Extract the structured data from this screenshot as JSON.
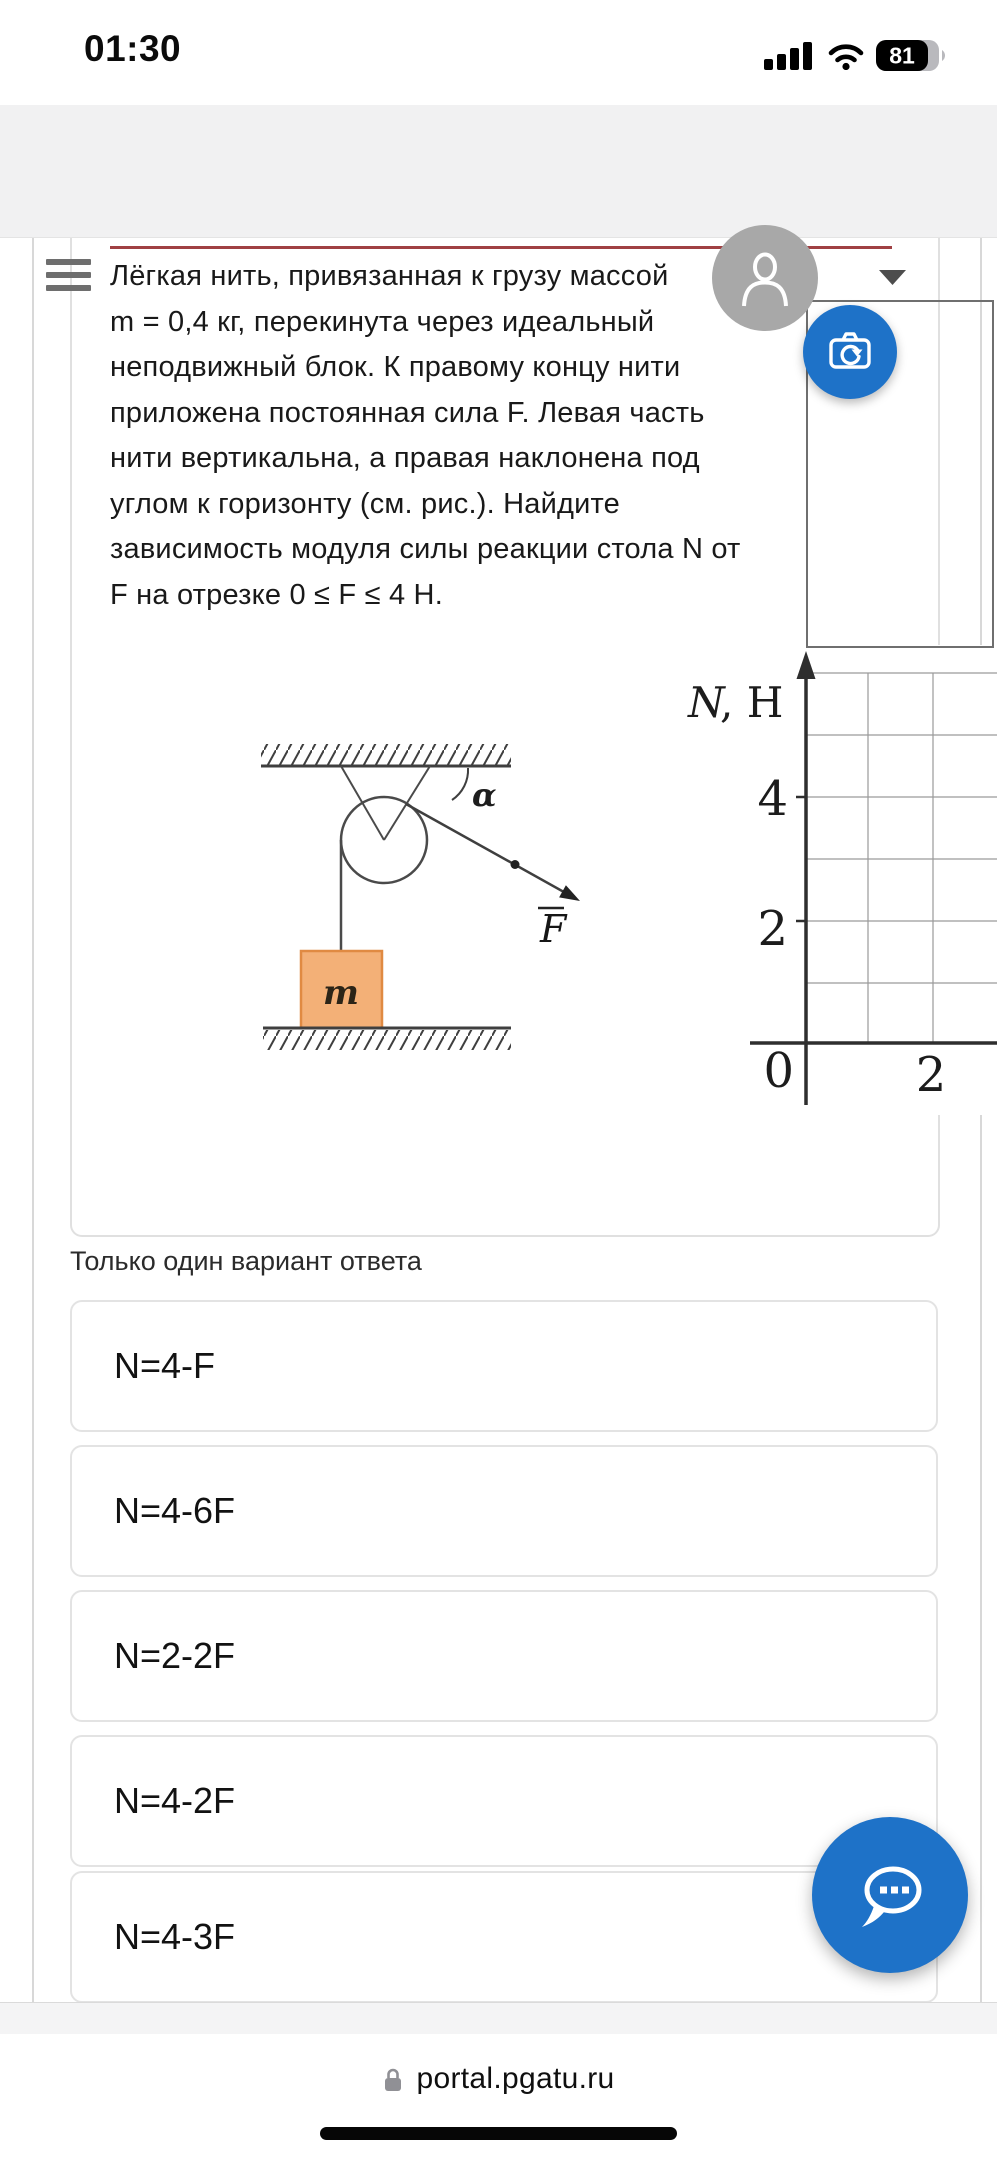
{
  "status_bar": {
    "time": "01:30",
    "battery_percent": "81"
  },
  "header": {
    "menu_icon": "hamburger-menu",
    "avatar_icon": "person-silhouette",
    "dropdown_icon": "chevron-down"
  },
  "question": {
    "divider_color": "#a04043",
    "lines": [
      "Лёгкая нить, привязанная к грузу массой",
      "m = 0,4 кг, перекинута через идеальный",
      "неподвижный блок. К правому концу нити",
      "приложена постоянная сила F. Левая часть",
      "нити вертикальна, а правая наклонена под",
      "углом к горизонту (см. рис.). Найдите",
      "зависимость модуля силы реакции стола N от",
      "F на отрезке 0 ≤ F ≤ 4 Н."
    ]
  },
  "figure": {
    "alpha_label": "α",
    "force_label": "F",
    "mass_label": "m",
    "block_color": "#f3b077"
  },
  "chart_data": {
    "type": "line",
    "title": "",
    "ylabel": "N, Н",
    "ylabel_symbol": "N",
    "ylabel_units": ", Н",
    "x_ticks": [
      "0",
      "2"
    ],
    "y_ticks": [
      "4",
      "2"
    ],
    "xlim": [
      0,
      3.4
    ],
    "ylim": [
      0,
      6
    ],
    "grid": true,
    "grid_step": 1,
    "series": []
  },
  "answers": {
    "label": "Только один вариант ответа",
    "options": [
      "N=4-F",
      "N=4-6F",
      "N=2-2F",
      "N=4-2F",
      "N=4-3F"
    ]
  },
  "floating_buttons": {
    "camera_icon": "camera-rescan",
    "chat_icon": "chat-bubble-dots",
    "color": "#1e72c8"
  },
  "browser": {
    "url": "portal.pgatu.ru",
    "lock_icon": "padlock"
  }
}
